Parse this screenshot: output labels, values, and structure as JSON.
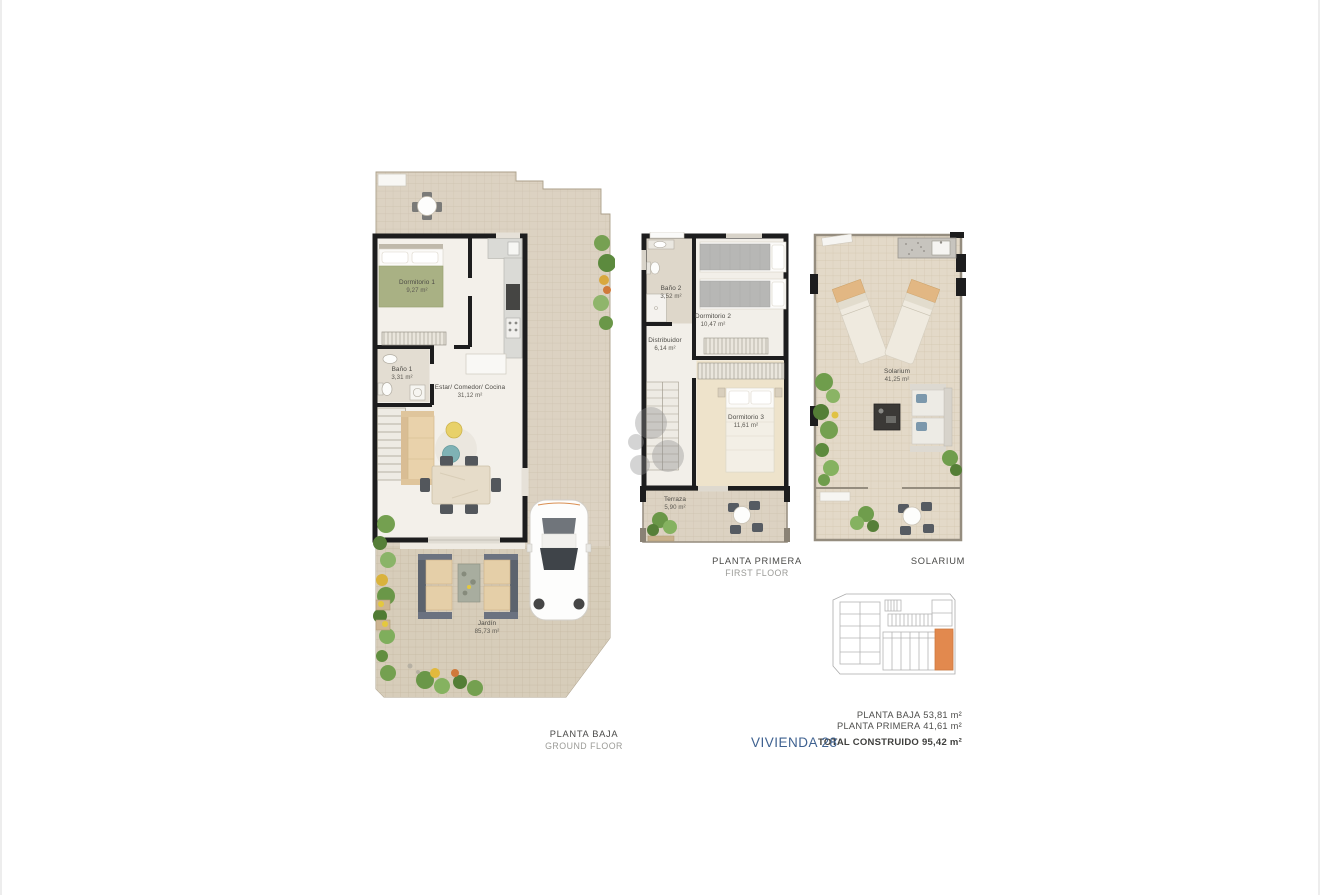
{
  "colors": {
    "accent_blue": "#3e6190",
    "keyplan_highlight_orange": "#e2894e",
    "wall_black": "#1d1d1e",
    "tile_beige": "#dcd2c2"
  },
  "plans": {
    "ground_floor": {
      "caption": "PLANTA BAJA",
      "caption_en": "GROUND FLOOR",
      "rooms": [
        {
          "name": "Dormitorio 1",
          "area": "9,27 m²"
        },
        {
          "name": "Baño 1",
          "area": "3,31 m²"
        },
        {
          "name": "Estar/ Comedor/ Cocina",
          "area": "31,12 m²"
        },
        {
          "name": "Jardín",
          "area": "85,73 m²"
        }
      ]
    },
    "first_floor": {
      "caption": "PLANTA PRIMERA",
      "caption_en": "FIRST FLOOR",
      "rooms": [
        {
          "name": "Baño 2",
          "area": "3,52 m²"
        },
        {
          "name": "Dormitorio 2",
          "area": "10,47 m²"
        },
        {
          "name": "Distribuidor",
          "area": "6,14 m²"
        },
        {
          "name": "Dormitorio 3",
          "area": "11,61 m²"
        },
        {
          "name": "Terraza",
          "area": "5,90 m²"
        }
      ]
    },
    "solarium": {
      "caption": "SOLARIUM",
      "rooms": [
        {
          "name": "Solarium",
          "area": "41,25 m²"
        }
      ]
    }
  },
  "summary": {
    "unit": "VIVIENDA 28",
    "areas": [
      {
        "label": "PLANTA BAJA",
        "value": "53,81 m²"
      },
      {
        "label": "PLANTA PRIMERA",
        "value": "41,61 m²"
      }
    ],
    "total_label": "TOTAL CONSTRUIDO",
    "total_value": "95,42 m²"
  }
}
